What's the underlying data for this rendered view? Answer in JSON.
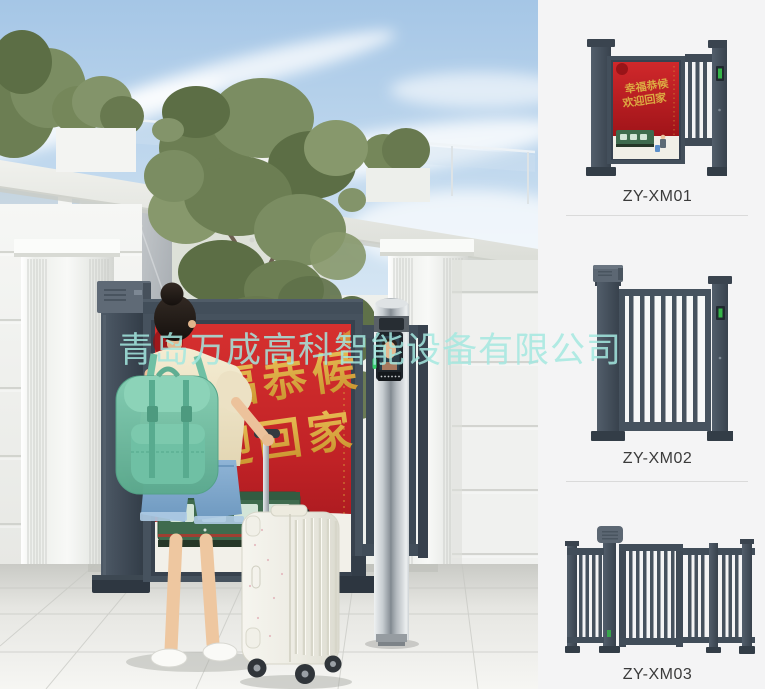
{
  "watermark": {
    "text": "青岛万成高科智能设备有限公司",
    "color": "#a3e8df"
  },
  "poster": {
    "line1": "幸福恭候",
    "line2": "欢迎回家",
    "gold": "#d9a43b",
    "red": "#c4272a"
  },
  "products": [
    {
      "label": "ZY-XM01"
    },
    {
      "label": "ZY-XM02"
    },
    {
      "label": "ZY-XM03"
    }
  ],
  "panel": {
    "background": "#f4f4f5",
    "gate_color": "#46525e",
    "reader_green": "#36b449"
  }
}
